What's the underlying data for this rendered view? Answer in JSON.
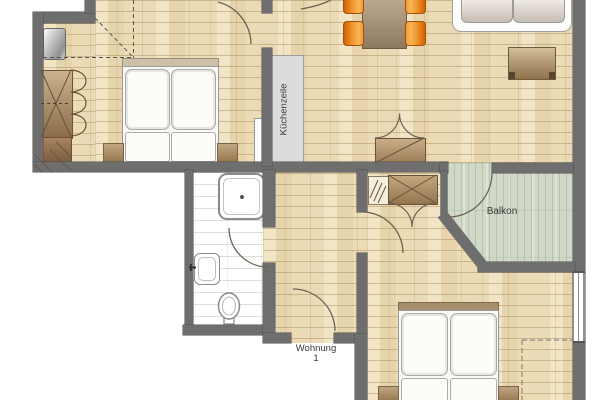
{
  "labels": {
    "kitchen_unit": "Küchenzeile",
    "balcony": "Balkon",
    "apartment_line1": "Wohnung",
    "apartment_line2": "1"
  },
  "palette": {
    "wall": "#6e6e6e",
    "wood_floor": "#eadbb6",
    "balcony_floor": "#d0d8c7",
    "bath_floor": "#ffffff",
    "kitchen_counter": "#dcdcdc",
    "chair_orange": "#ef9225",
    "table_brown": "#a78f70",
    "cabinet_tan": "#b89a74",
    "bed_white": "#fcfbf5",
    "sofa_cushion": "#d6cdc6",
    "label_text": "#3a3a3a",
    "door_arc": "#6f6253"
  },
  "furniture_semantics": [
    "double-bed-1",
    "nightstand",
    "tall-metal-cabinet",
    "wardrobe-with-x",
    "low-cabinet",
    "dining-table",
    "dining-chair",
    "sofa",
    "sideboard",
    "kitchen-unit-counter",
    "hall-closet",
    "shoe-rack",
    "shower",
    "washbasin",
    "toilet",
    "double-bed-2"
  ]
}
